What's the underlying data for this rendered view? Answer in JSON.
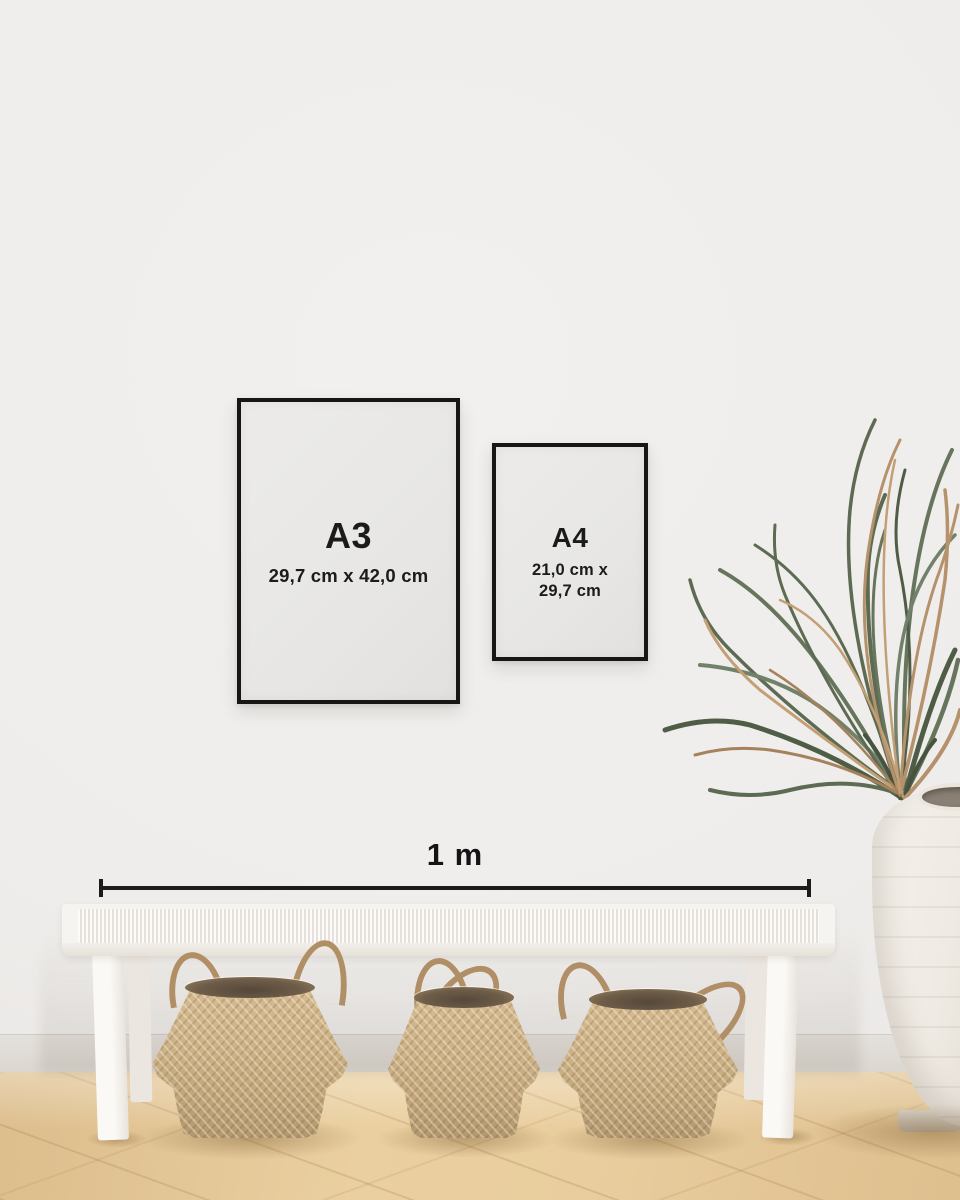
{
  "frames": [
    {
      "label": "A3",
      "size_lines": [
        "29,7 cm x 42,0 cm"
      ]
    },
    {
      "label": "A4",
      "size_lines": [
        "21,0 cm x",
        "29,7 cm"
      ]
    }
  ],
  "scale_bar": {
    "label": "1 m"
  },
  "colors": {
    "frame_border": "#161616",
    "paper": "#e8e7e5",
    "text": "#1b1b1b",
    "scale_line": "#1c1c1c",
    "wall": "#efedeb",
    "baseboard": "#dfdad5",
    "floor_light": "#eacfa0",
    "floor_dark": "#dcbd8c",
    "bench_white": "#f6f4f0",
    "basket_tan": "#ccb185",
    "basket_rim_dark": "#6d5c48",
    "vase_cream": "#efeae3",
    "leaf_green": "#5c6b52",
    "leaf_tan": "#b5926b"
  },
  "objects": {
    "bench": "white-woven-bench",
    "baskets": [
      "seagrass-belly-basket",
      "seagrass-belly-basket",
      "seagrass-belly-basket"
    ],
    "vase": "white-ceramic-floor-vase",
    "plant": "dried-palm-plant"
  }
}
